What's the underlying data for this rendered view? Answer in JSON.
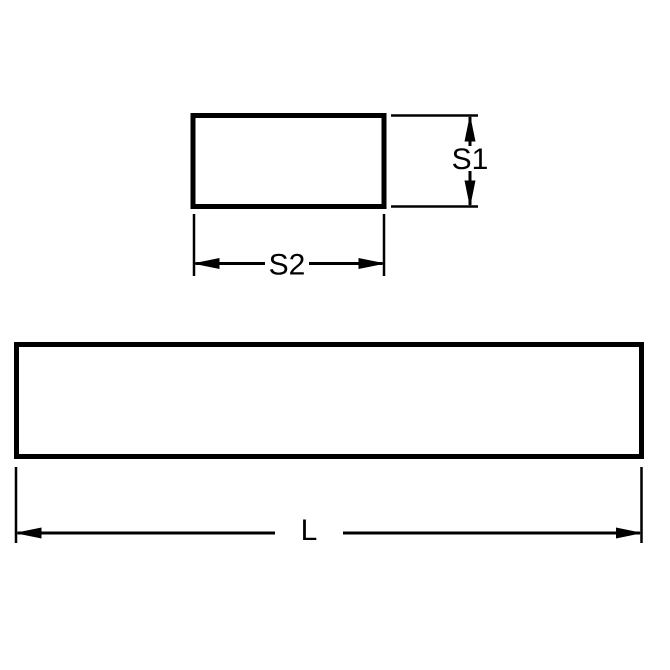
{
  "diagram": {
    "type": "technical-dimension-drawing",
    "labels": {
      "s1": "S1",
      "s2": "S2",
      "length": "L"
    },
    "colors": {
      "line": "#000000",
      "background": "#ffffff"
    }
  }
}
